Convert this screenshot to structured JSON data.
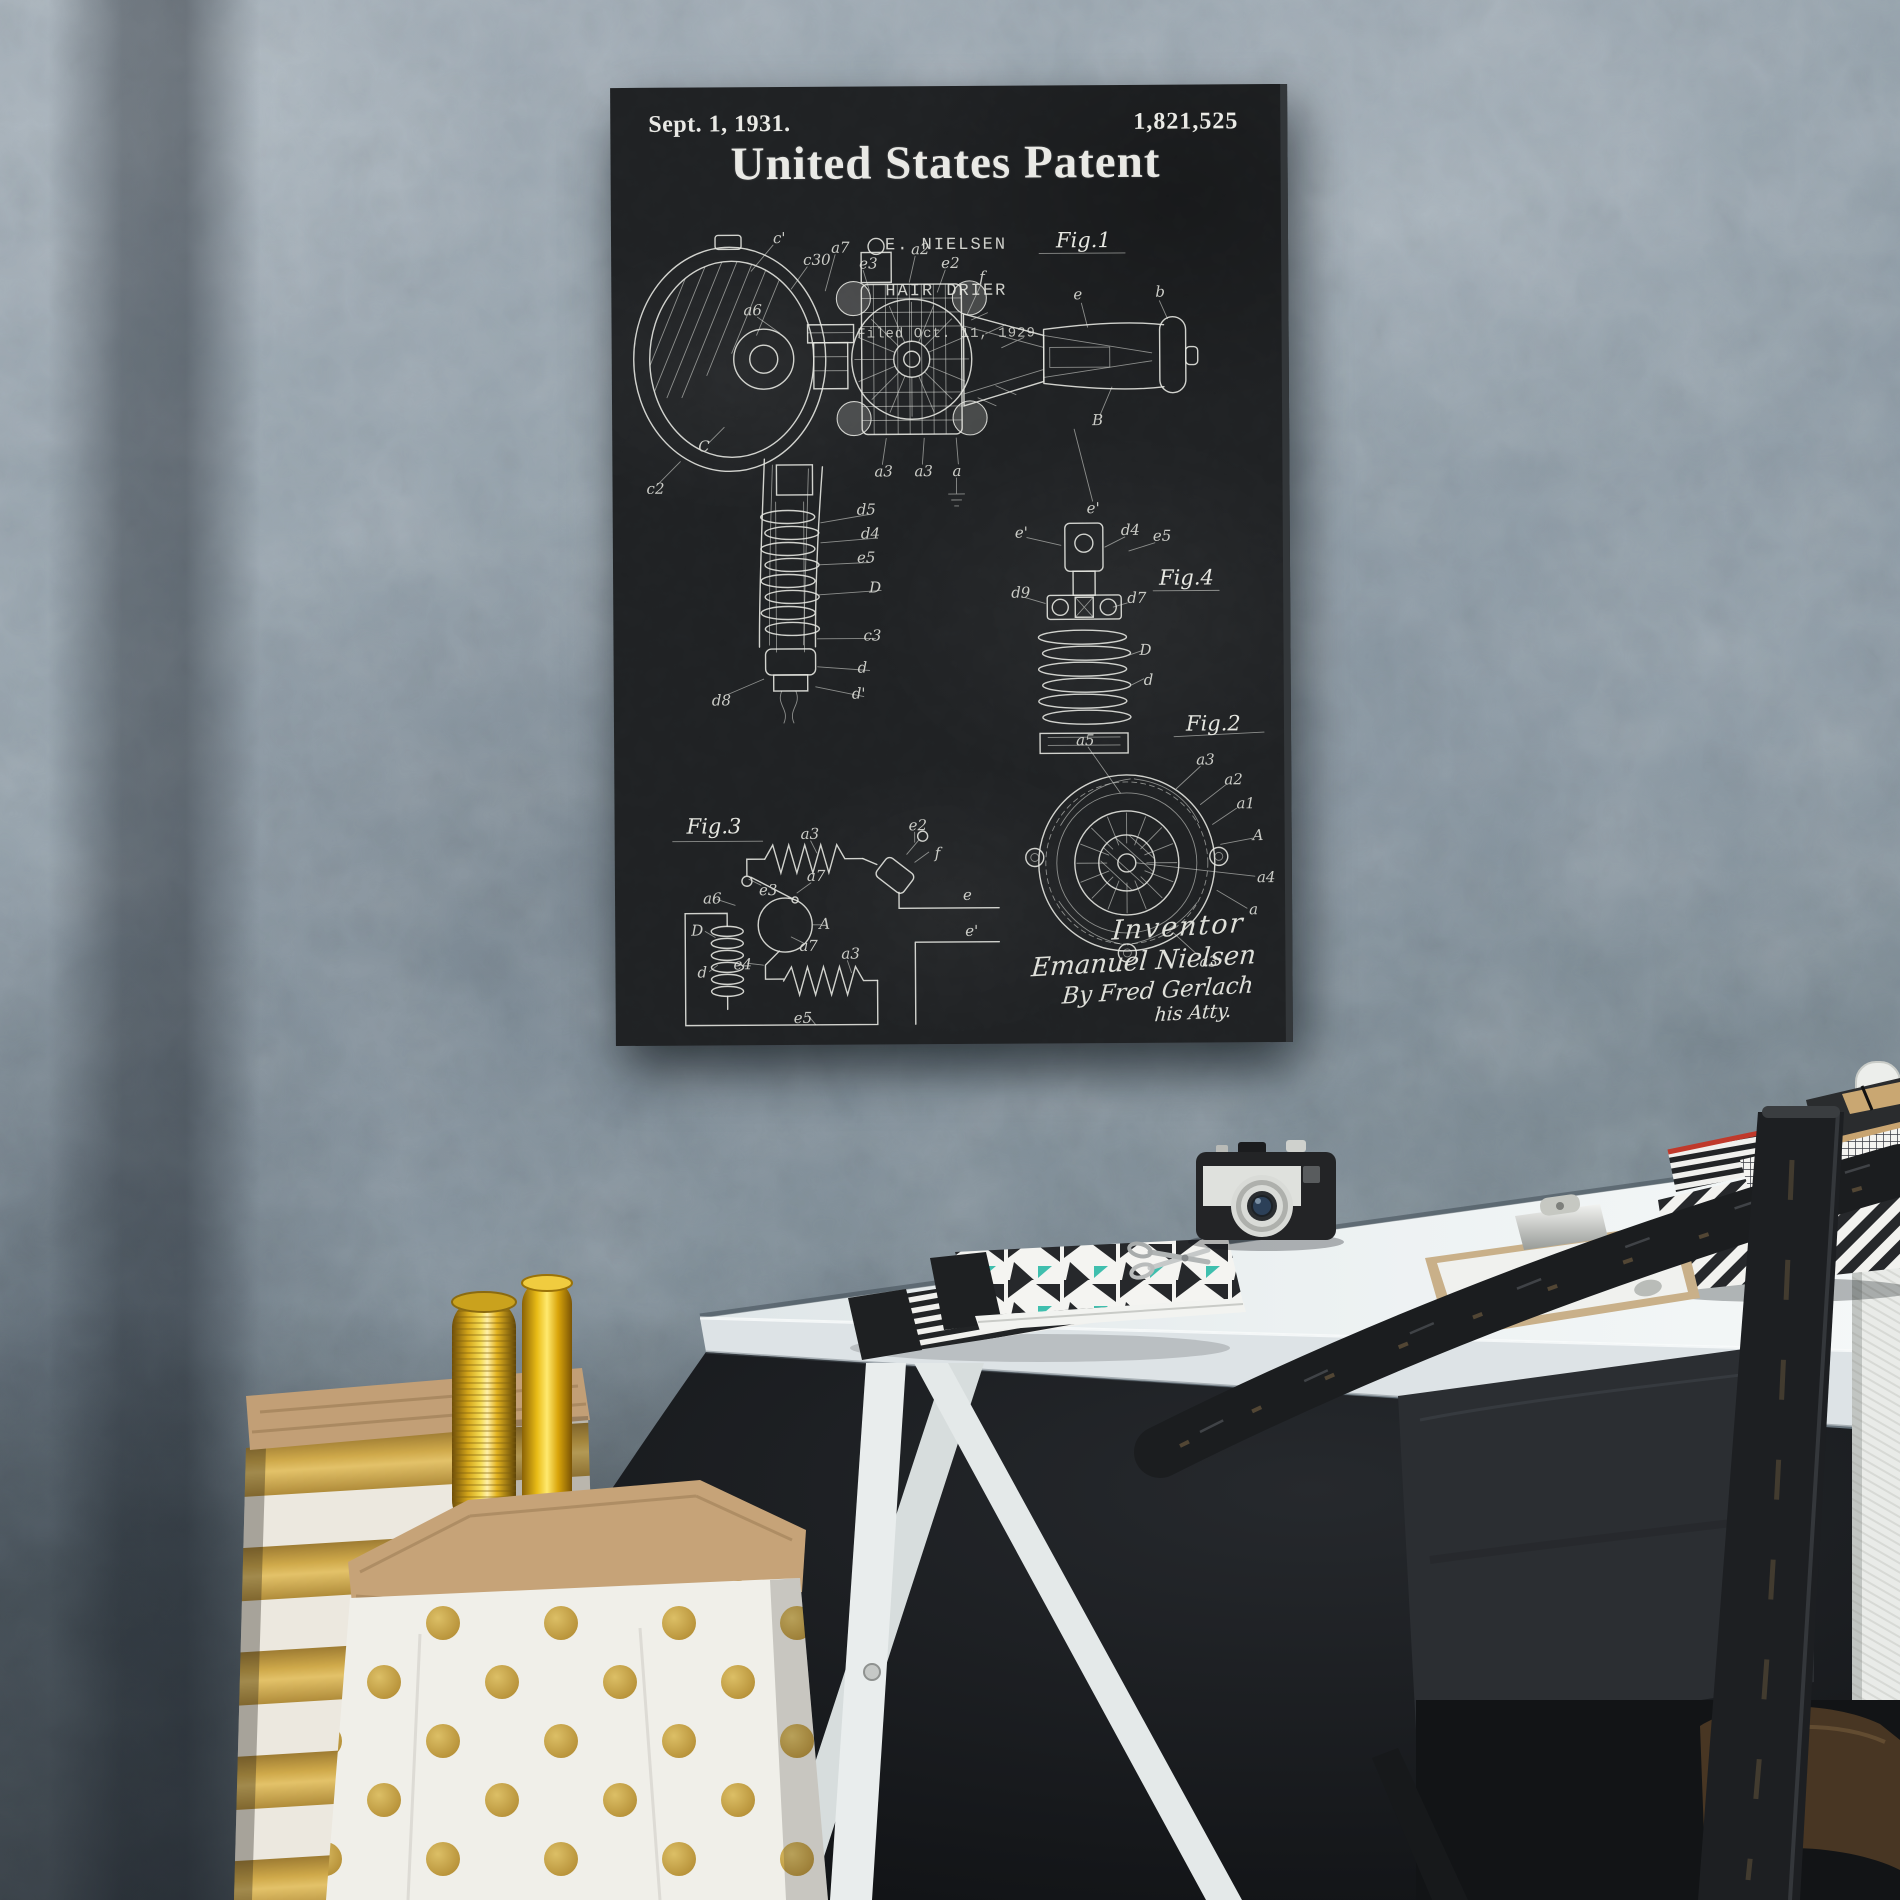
{
  "scene": {
    "description": "Chalkboard-style framed patent print of a 1931 hair drier hanging on a textured gray plaster wall above a white trestle desk with a vintage camera, patterned notebooks, a clipboard, striped storage boxes, a distressed black bistro chair, and paper bags holding rolls of gold gift wrap."
  },
  "poster": {
    "date": "Sept. 1, 1931.",
    "patent_number": "1,821,525",
    "title": "United States Patent",
    "inventor_line": "E. NIELSEN",
    "subject": "HAIR DRIER",
    "filed_line": "Filed Oct. 11, 1929",
    "fig_labels": {
      "fig1": "Fig.1",
      "fig2": "Fig.2",
      "fig3": "Fig.3",
      "fig4": "Fig.4"
    },
    "signature": {
      "line1": "Inventor",
      "line2": "Emanuel Nielsen",
      "line3": "By Fred Gerlach",
      "line4": "his Atty."
    },
    "fig1_labels": [
      "c'",
      "c30",
      "a7",
      "e3",
      "a2",
      "e2",
      "f",
      "B",
      "e",
      "b",
      "e'",
      "C",
      "c2",
      "a3",
      "a3",
      "a",
      "d5",
      "d4",
      "e5",
      "D",
      "c3",
      "d",
      "d'",
      "d8",
      "a6"
    ],
    "fig2_labels": [
      "a5",
      "a3",
      "a2",
      "a1",
      "A",
      "a4",
      "a",
      "a3"
    ],
    "fig3_labels": [
      "a3",
      "e2",
      "f",
      "e3",
      "a6",
      "a7",
      "A",
      "a7",
      "e4",
      "a3",
      "D",
      "d",
      "e5",
      "e",
      "e'"
    ],
    "fig4_labels": [
      "e'",
      "d4",
      "e5",
      "d9",
      "d7",
      "D",
      "d"
    ]
  },
  "colors": {
    "chalkboard": "#1f2123",
    "chalk": "#e8e8e4",
    "wall": "#8e9aa5",
    "desk": "#eef2f3",
    "gold": "#c9a64a",
    "gold_foil": "#f6dd55",
    "teal_accent": "#3fbfae",
    "red_accent": "#c0392b",
    "kraft": "#c6a277",
    "camera_silver": "#dfe1dd",
    "chair_black": "#1b1d1f"
  }
}
